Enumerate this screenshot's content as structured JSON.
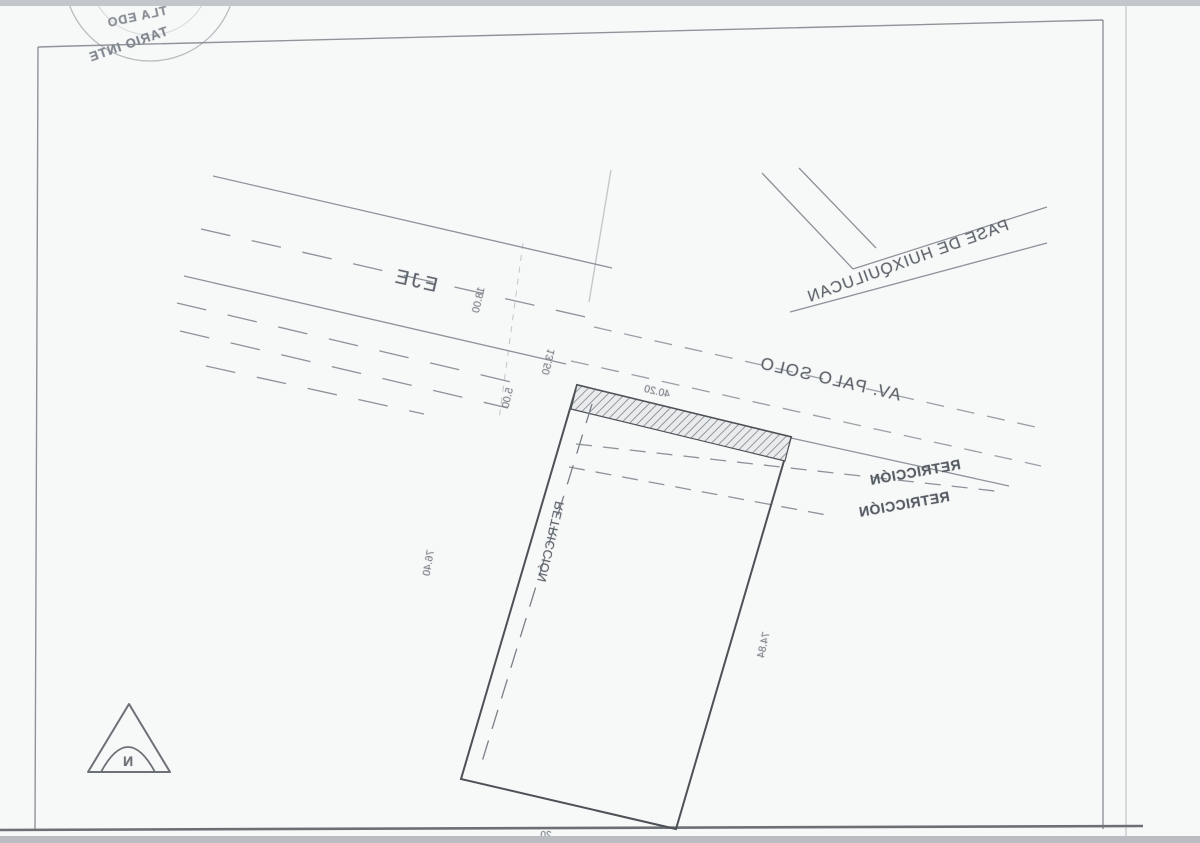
{
  "stamp": {
    "arc_text_top": "TLA EDO",
    "arc_text_bottom": "TARIO INTE"
  },
  "labels": {
    "eje": "EJE",
    "av_palo_solo": "AV. PALO SOLO",
    "pase_de_huixquilucan": "PASE DE HUIXQUILUCAN",
    "restriction_right_1": "RETRICCIÓN",
    "restriction_right_2": "RETRICCIÓN",
    "restriction_lot": "RETRICCIÓN"
  },
  "dimensions": {
    "front_width": "40.20",
    "left_depth": "76.40",
    "right_depth": "74.84",
    "road_width_18": "18.00",
    "road_width_13_50": "13.50",
    "road_width_5": "5.00",
    "bottom_partial": "20"
  },
  "north_arrow": {
    "label": "N"
  },
  "colors": {
    "paper": "#f7f8f8",
    "ink_light": "#8d939a",
    "ink_frame": "#7c828a",
    "ink_dark": "#4d5257",
    "edge_strip": "#c3c7cb"
  }
}
